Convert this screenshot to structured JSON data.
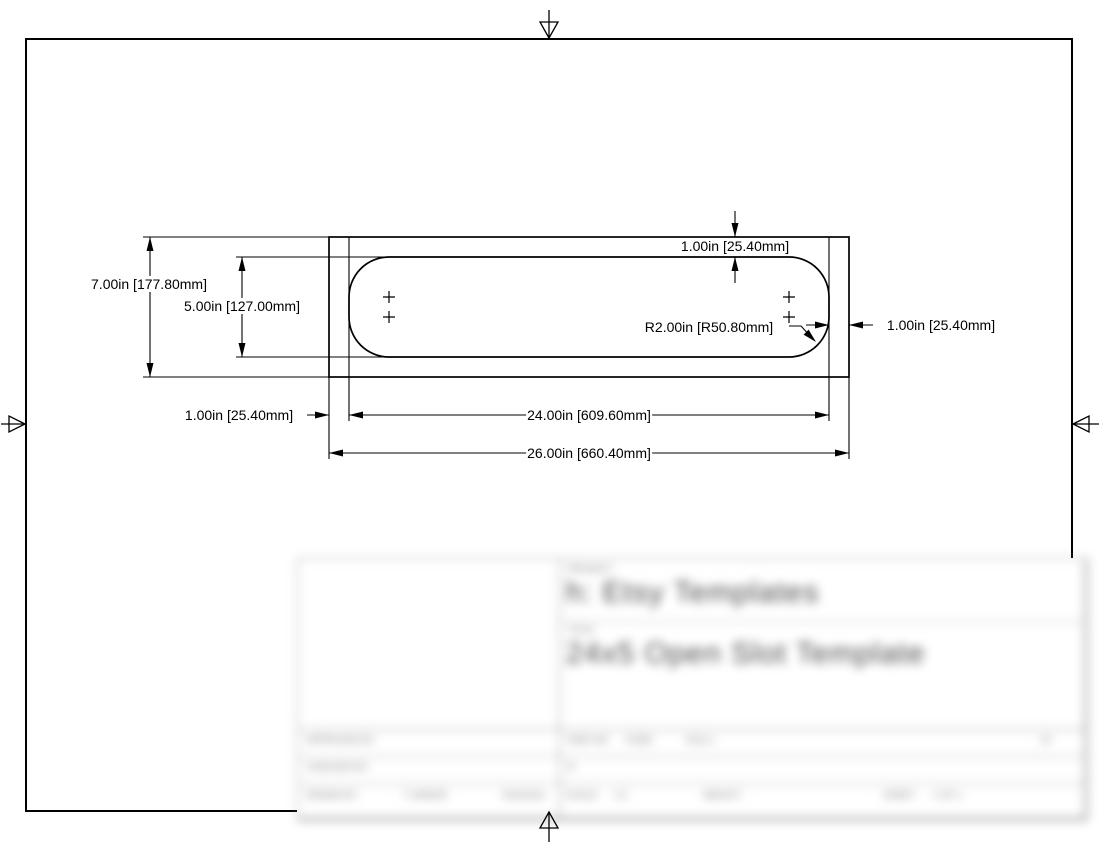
{
  "page": {
    "background": "#ffffff",
    "line_color": "#000000"
  },
  "dimensions": {
    "overall_height": "7.00in [177.80mm]",
    "slot_height": "5.00in [127.00mm]",
    "top_offset": "1.00in [25.40mm]",
    "right_offset": "1.00in [25.40mm]",
    "left_offset": "1.00in [25.40mm]",
    "corner_radius": "R2.00in [R50.80mm]",
    "slot_width": "24.00in [609.60mm]",
    "overall_width": "26.00in [660.40mm]"
  },
  "title_block": {
    "project_label": "PROJECT",
    "project_name": "h: Etsy Templates",
    "title_label": "TITLE",
    "title_name": "24x5 Open Slot Template",
    "approved_label": "APPROVED BY:",
    "checked_label": "CHECKED BY:",
    "drawn_label": "DRAWN BY:",
    "drawn_name": "T. MAKER",
    "drawn_date": "8/16/2021",
    "dwg_label": "DWG NO",
    "code_label": "CODE",
    "dwg_value": "1012-1",
    "size_value": "B",
    "rev_value": "1X",
    "scale_label": "SCALE",
    "scale_value": "1:2",
    "weight_label": "WEIGHT",
    "sheet_label": "SHEET",
    "sheet_value": "1 OF 1"
  }
}
